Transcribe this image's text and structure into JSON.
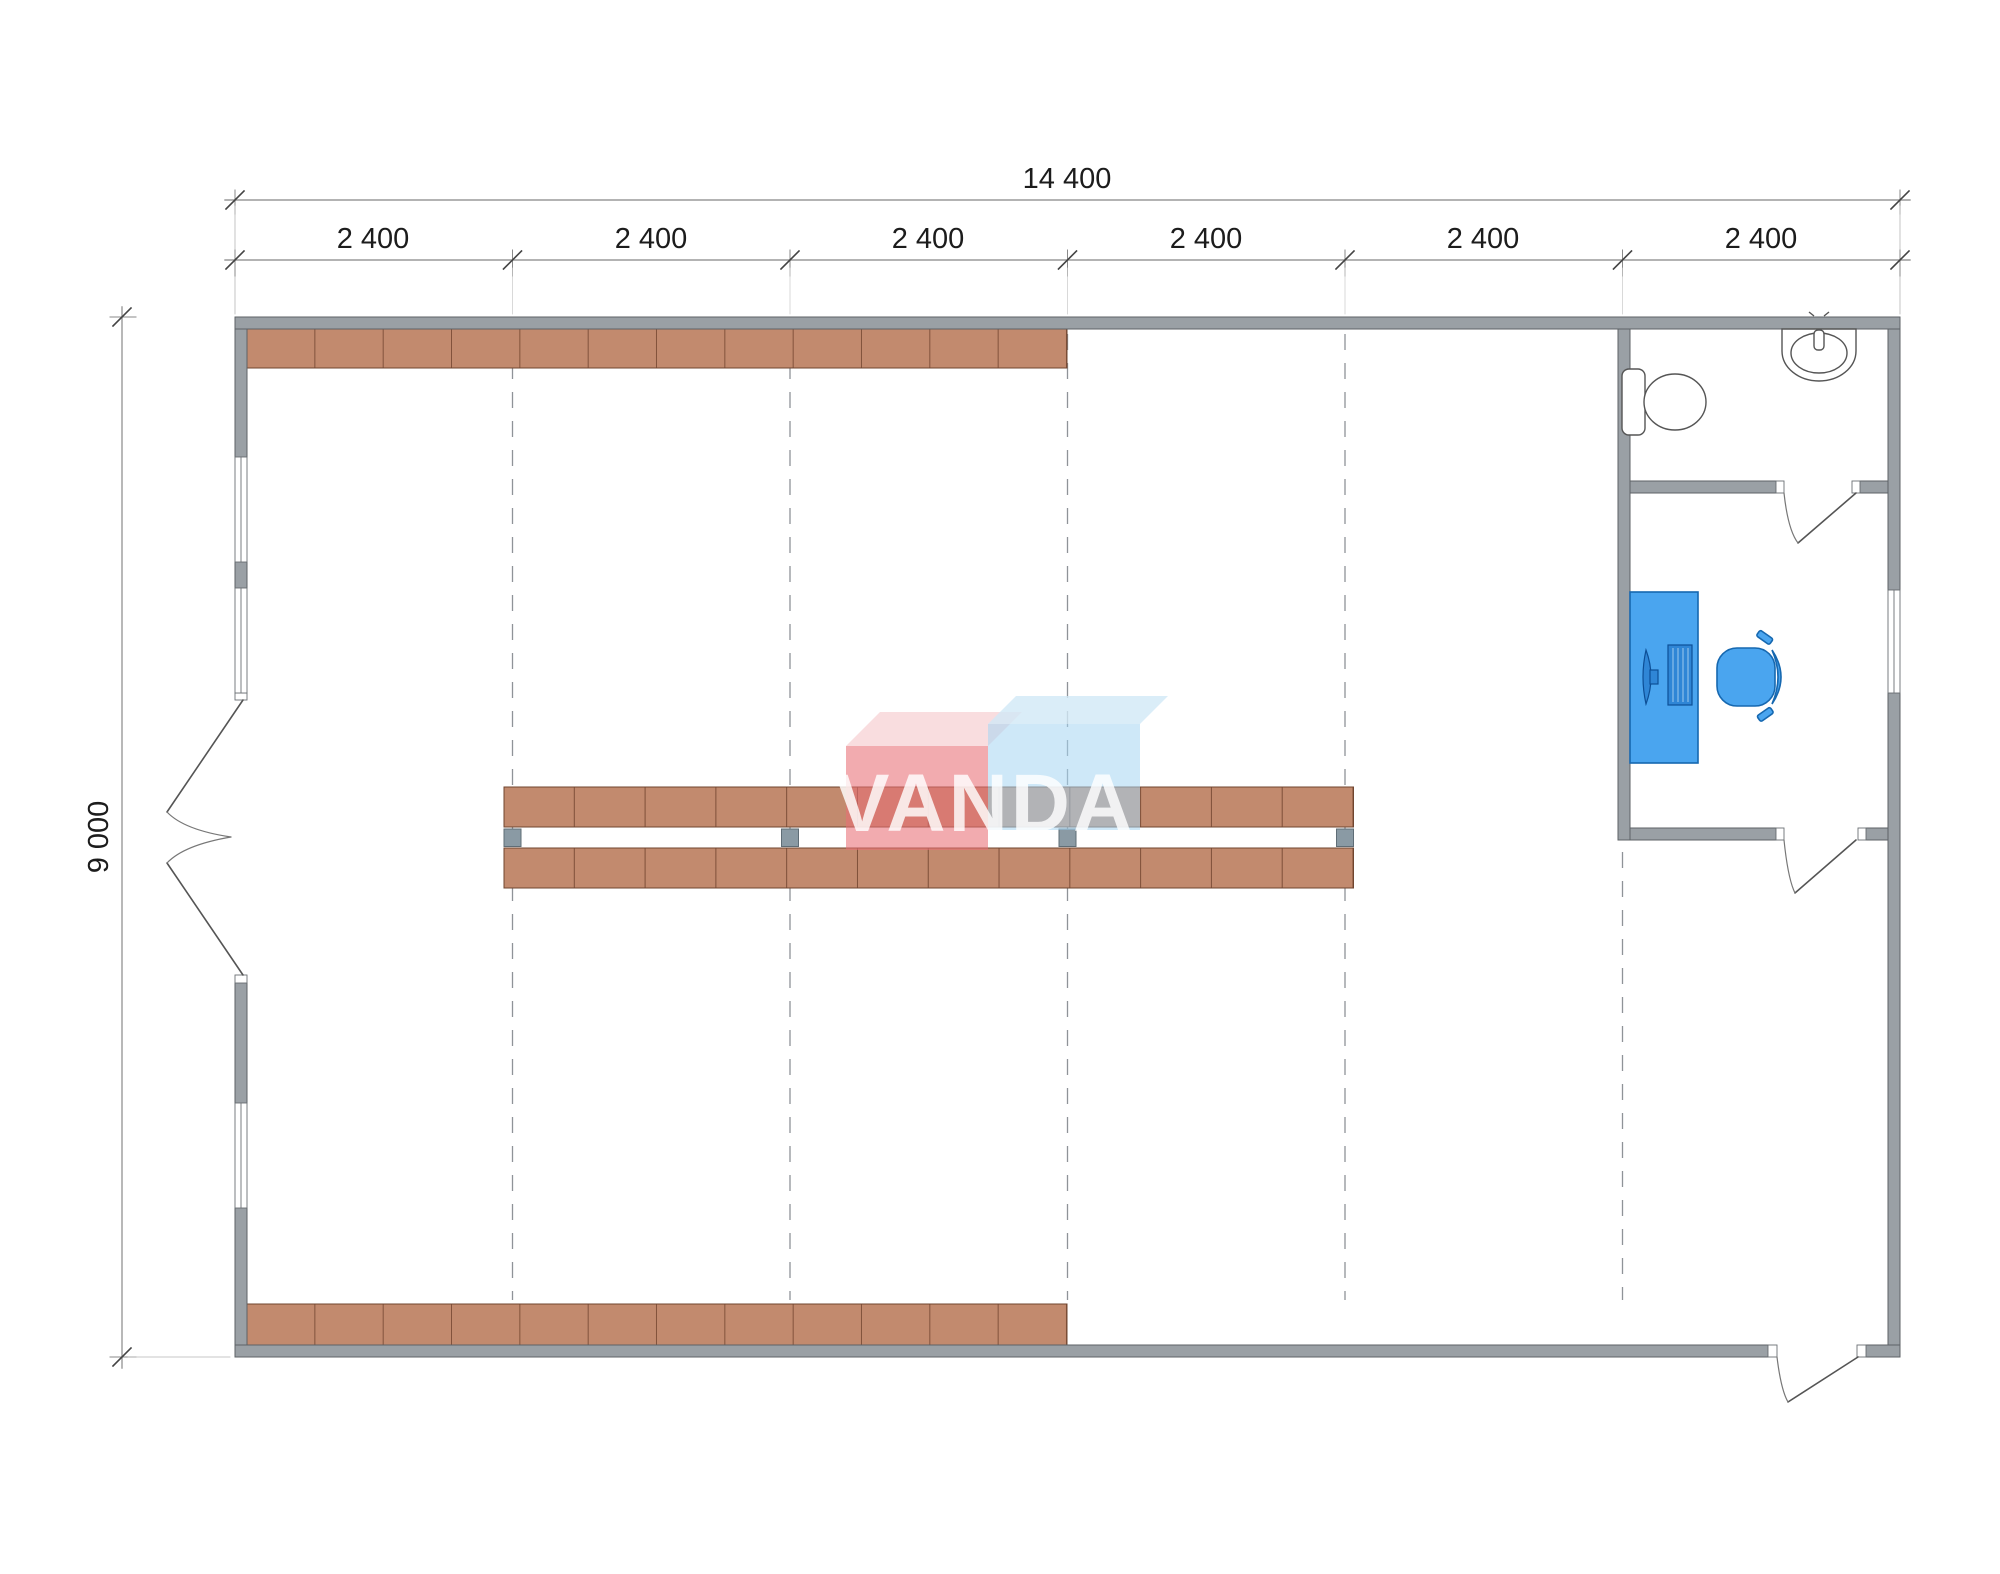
{
  "drawing_type": "floor-plan",
  "dimensions": {
    "overall_width_label": "14 400",
    "overall_height_label": "9 000",
    "bay_labels": [
      "2 400",
      "2 400",
      "2 400",
      "2 400",
      "2 400",
      "2 400"
    ]
  },
  "watermark": {
    "text": "VANDA",
    "pink_box_color": "#ec8186",
    "blue_box_color": "#a6d6f3"
  },
  "colors": {
    "wall_fill": "#9aa0a5",
    "wall_outline": "#5d6266",
    "shelf_fill": "#c28a6e",
    "shelf_outline": "#70452f",
    "column_fill": "#8a9aa4",
    "furniture_fill": "#4aa5ef",
    "furniture_outline": "#1668b0",
    "grid_dash": "#8f9398"
  },
  "fixtures": [
    "toilet",
    "sink",
    "computer-desk",
    "monitor",
    "keyboard",
    "office-chair"
  ],
  "openings": [
    "double-entry-door",
    "bathroom-door",
    "office-door",
    "rear-exit-door",
    "window-left-1",
    "window-left-2",
    "window-left-3",
    "window-right-office"
  ]
}
